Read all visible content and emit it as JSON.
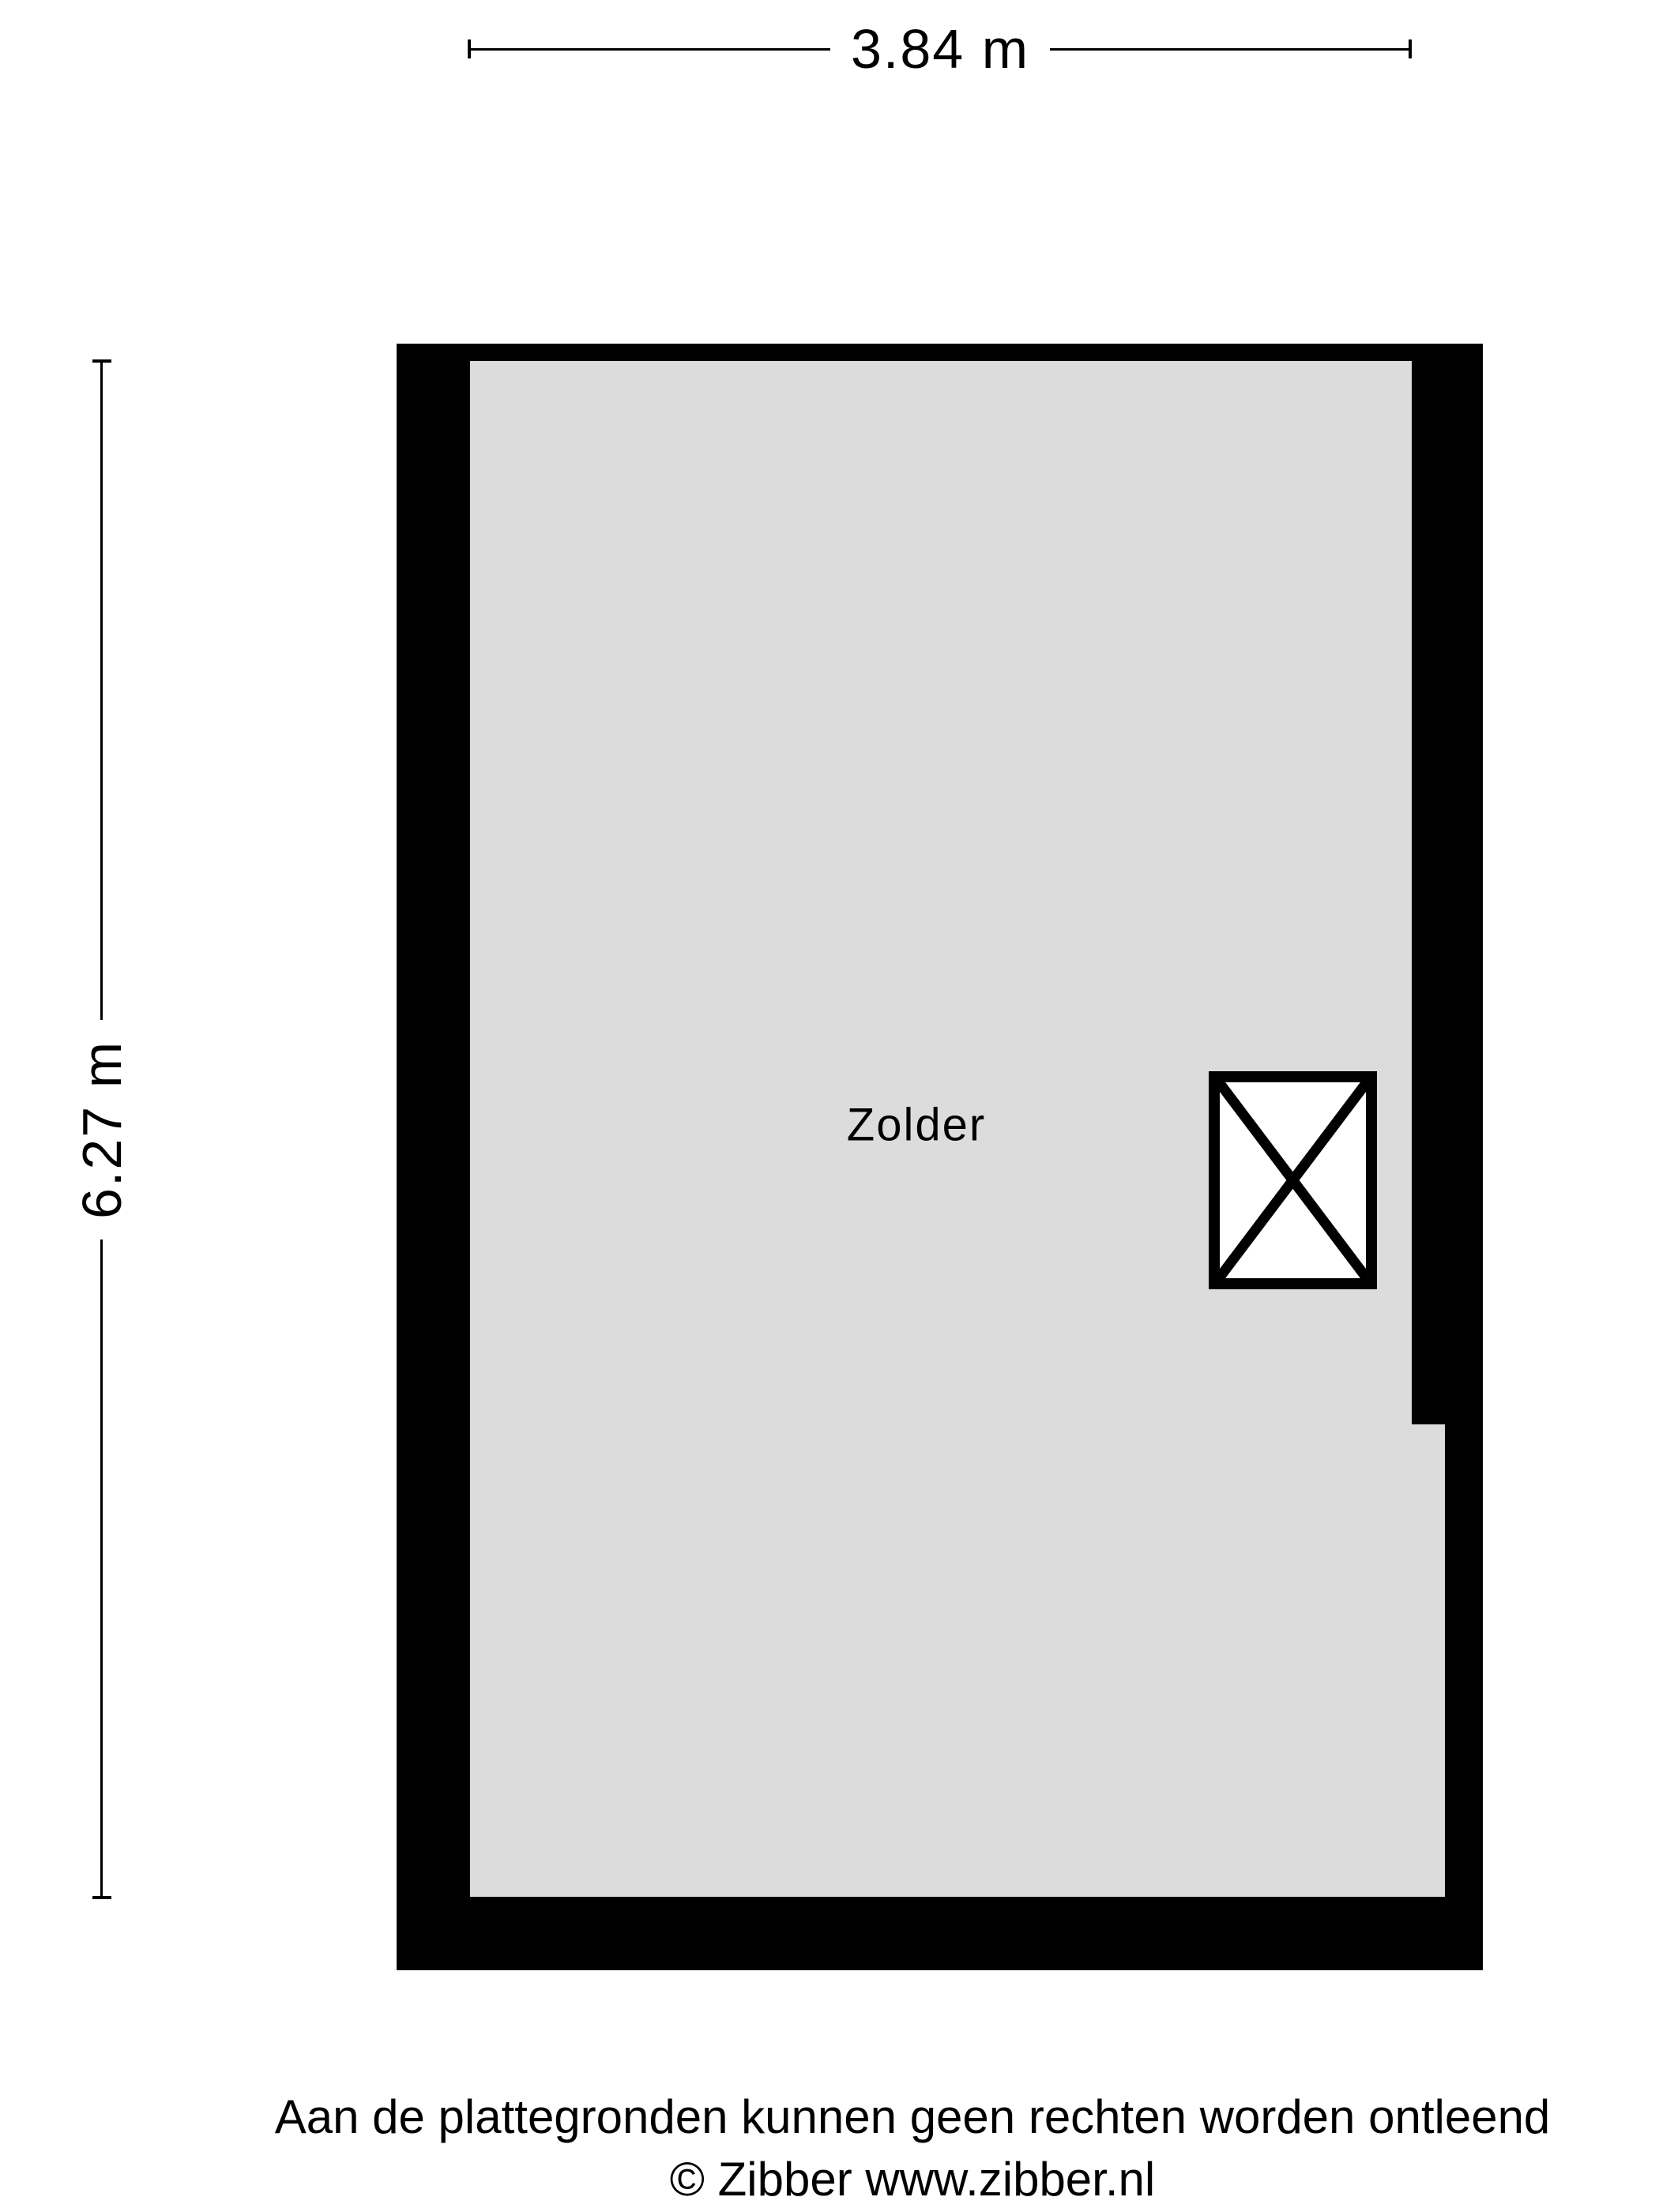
{
  "dimensions": {
    "width_label": "3.84 m",
    "height_label": "6.27 m"
  },
  "room": {
    "label": "Zolder",
    "symbol": "crossed-rectangle-stair-opening"
  },
  "footer": {
    "line1": "Aan de plattegronden kunnen geen rechten worden ontleend",
    "line2": "© Zibber www.zibber.nl"
  },
  "colors": {
    "wall": "#000000",
    "floor": "#dcdcdc",
    "background": "#ffffff",
    "text": "#000000"
  }
}
